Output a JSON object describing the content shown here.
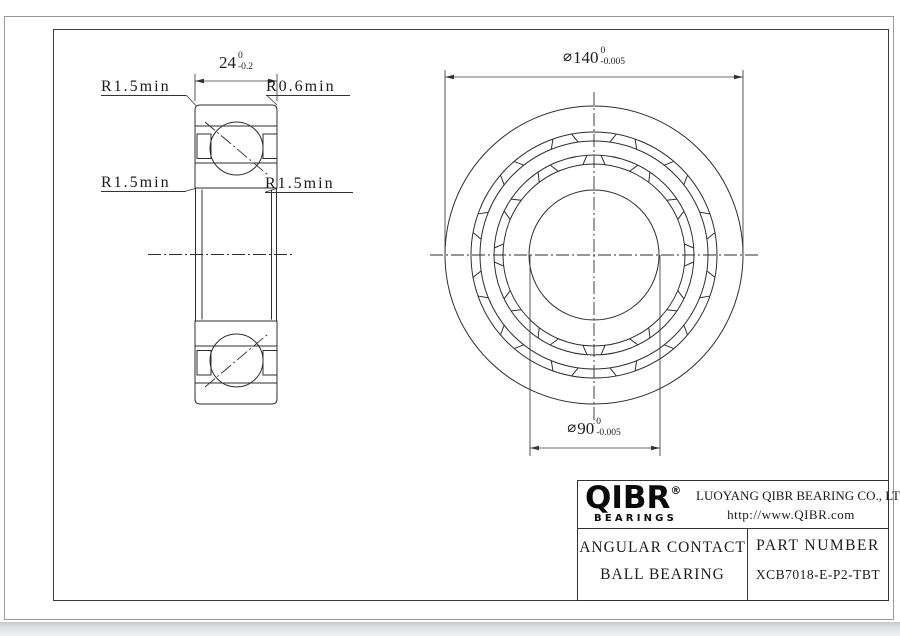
{
  "drawing": {
    "section_view": {
      "width_dim": {
        "value": "24",
        "tol_upper": "0",
        "tol_lower": "-0.2"
      },
      "labels": {
        "top_left": "R1.5min",
        "top_right": "R0.6min",
        "mid_left": "R1.5min",
        "mid_right": "R1.5min"
      }
    },
    "front_view": {
      "outer_dia": {
        "symbol": "⌀",
        "value": "140",
        "tol_upper": "0",
        "tol_lower": "-0.005"
      },
      "bore_dia": {
        "symbol": "⌀",
        "value": "90",
        "tol_upper": "0",
        "tol_lower": "-0.005"
      }
    }
  },
  "title_block": {
    "logo": {
      "brand": "QIBR",
      "registered": "®",
      "sub": "BEARINGS"
    },
    "company": "LUOYANG QIBR BEARING CO., LTD",
    "website": "http://www.QIBR.com",
    "product": {
      "line1": "ANGULAR CONTACT",
      "line2": "BALL BEARING"
    },
    "part": {
      "label": "PART NUMBER",
      "number": "XCB7018-E-P2-TBT"
    }
  }
}
